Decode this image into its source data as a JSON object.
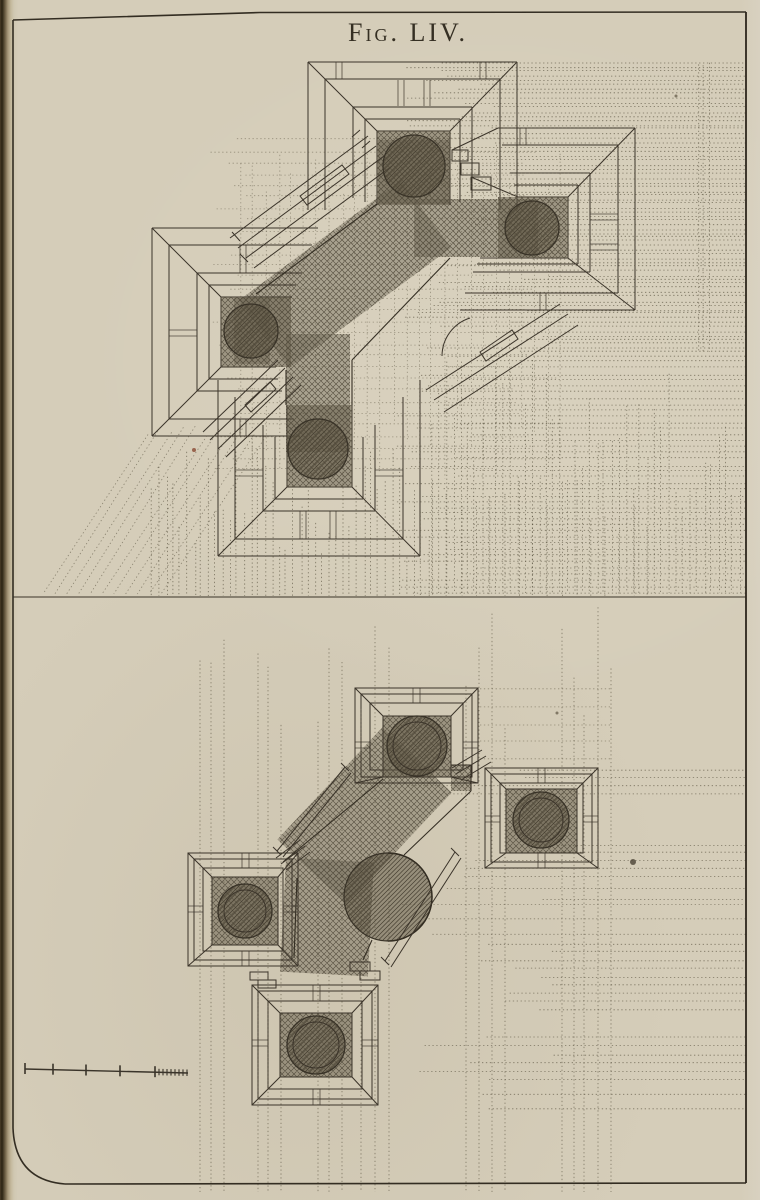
{
  "caption": {
    "prefix": "Fig.",
    "numeral": "LIV."
  },
  "colors": {
    "paper": "#d5cdb9",
    "ink": "#3a342a",
    "frame": "#332d22",
    "construction": "#57503d",
    "hatch_line": "#4f4839"
  },
  "scale_bar": {
    "x_start": 25,
    "x_end": 188,
    "y_left": 1069,
    "y_right": 1073,
    "major_ticks": [
      25,
      53,
      86,
      120,
      155
    ],
    "minor_from": 155,
    "minor_to": 188,
    "minor_step": 4
  },
  "specks": [
    {
      "x": 633,
      "y": 862,
      "r": 3,
      "c": "#4a4234"
    },
    {
      "x": 194,
      "y": 450,
      "r": 2,
      "c": "#8a4a33"
    },
    {
      "x": 676,
      "y": 96,
      "r": 1.5,
      "c": "#6b6350"
    },
    {
      "x": 557,
      "y": 713,
      "r": 1.5,
      "c": "#6b6350"
    }
  ],
  "construction": {
    "groups": [
      {
        "dir": "h",
        "y0": 63,
        "y1": 200,
        "n": 32,
        "xa": 500,
        "jx": 110,
        "xb": 746,
        "seed": 11,
        "op": 0.75
      },
      {
        "dir": "h",
        "y0": 203,
        "y1": 352,
        "n": 36,
        "xa": 560,
        "jx": 160,
        "xb": 746,
        "seed": 12,
        "op": 0.75
      },
      {
        "dir": "h",
        "y0": 356,
        "y1": 592,
        "n": 40,
        "xa": 480,
        "jx": 90,
        "xb": 746,
        "seed": 13,
        "op": 0.7
      },
      {
        "dir": "v",
        "x0": 432,
        "x1": 740,
        "n": 44,
        "ya": 360,
        "jy": 150,
        "yb": 593,
        "seed": 14,
        "op": 0.7
      },
      {
        "dir": "v",
        "x0": 152,
        "x1": 428,
        "n": 40,
        "ya": 440,
        "jy": 120,
        "yb": 596,
        "seed": 15,
        "op": 0.75
      },
      {
        "dir": "v",
        "x0": 432,
        "x1": 648,
        "n": 16,
        "ya": 470,
        "jy": 70,
        "yb": 596,
        "seed": 16,
        "op": 0.7
      },
      {
        "dir": "dg",
        "n": 11,
        "x0": 148,
        "x1": 266,
        "ya": 432,
        "dx": -105,
        "yb": 594,
        "seed": 17,
        "op": 0.6
      },
      {
        "dir": "v",
        "x0": 699,
        "x1": 709,
        "n": 3,
        "ya": 62,
        "jy": 4,
        "yb": 352,
        "seed": 18,
        "op": 0.7
      },
      {
        "dir": "h",
        "y0": 140,
        "y1": 470,
        "n": 30,
        "xa": 250,
        "jx": 40,
        "xb": 560,
        "jx2": 70,
        "seed": 19,
        "op": 0.5
      },
      {
        "dir": "v",
        "x0": 240,
        "x1": 560,
        "n": 26,
        "ya": 140,
        "jy": 60,
        "yb": 480,
        "jy2": 70,
        "seed": 20,
        "op": 0.5
      },
      {
        "dir": "vg",
        "xs": [
          200,
          211,
          224,
          258,
          268,
          281,
          318,
          329,
          342,
          361,
          375,
          389,
          466,
          479,
          492,
          505,
          562,
          574,
          584,
          598,
          611
        ],
        "ya": 600,
        "vary": 140,
        "yb": 1192,
        "seed": 21,
        "op": 0.7
      },
      {
        "dir": "hb",
        "bands": [
          [
            770,
            794,
            4
          ],
          [
            845,
            869,
            4
          ],
          [
            877,
            899,
            3
          ],
          [
            944,
            1010,
            9
          ],
          [
            1038,
            1072,
            5
          ],
          [
            1080,
            1108,
            3
          ]
        ],
        "xa": 560,
        "jx": 170,
        "xb": 746,
        "seed": 22,
        "op": 0.7
      },
      {
        "dir": "h",
        "y0": 690,
        "y1": 760,
        "n": 5,
        "xa": 480,
        "jx": 0,
        "xb": 612,
        "seed": 23,
        "op": 0.55
      },
      {
        "dir": "h",
        "y0": 905,
        "y1": 935,
        "n": 3,
        "xa": 460,
        "jx": 60,
        "xb": 746,
        "seed": 24,
        "op": 0.6
      }
    ]
  }
}
